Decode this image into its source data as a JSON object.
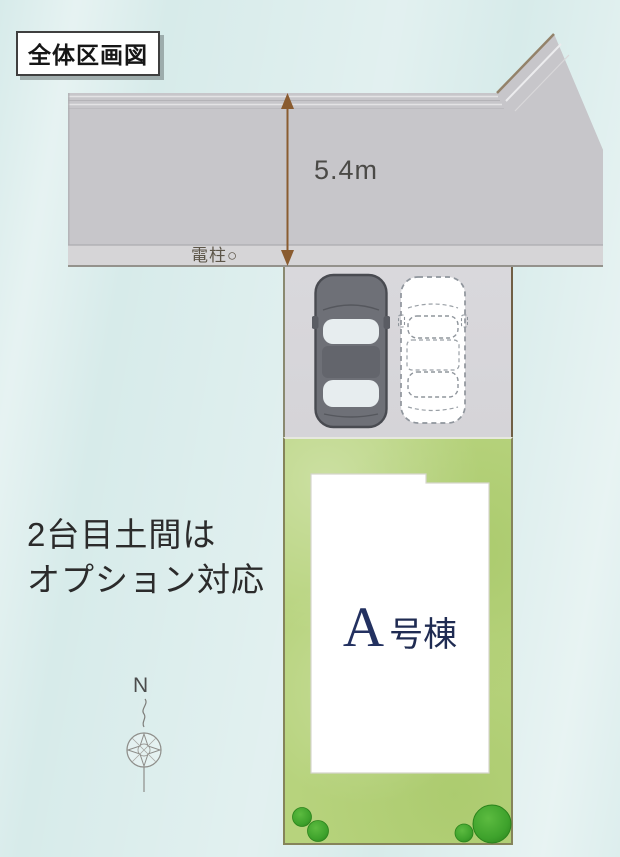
{
  "title": "全体区画図",
  "road": {
    "width_label": "5.4m",
    "pole_label": "電柱○"
  },
  "annotation": {
    "line1": "2台目土間は",
    "line2": "オプション対応"
  },
  "building": {
    "letter": "A",
    "suffix": "号棟",
    "full_label": "A号棟"
  },
  "compass": {
    "north_label": "N"
  },
  "colors": {
    "background": "#d7ebea",
    "road": "#c9c8cc",
    "sidewalk": "#d6d5d7",
    "parking": "#d7d6da",
    "grass": "#b7d37d",
    "tree": "#3ea22c",
    "dimension_arrow": "#8a5c30",
    "building_label": "#233160",
    "dark_car_body": "#6e7077"
  }
}
